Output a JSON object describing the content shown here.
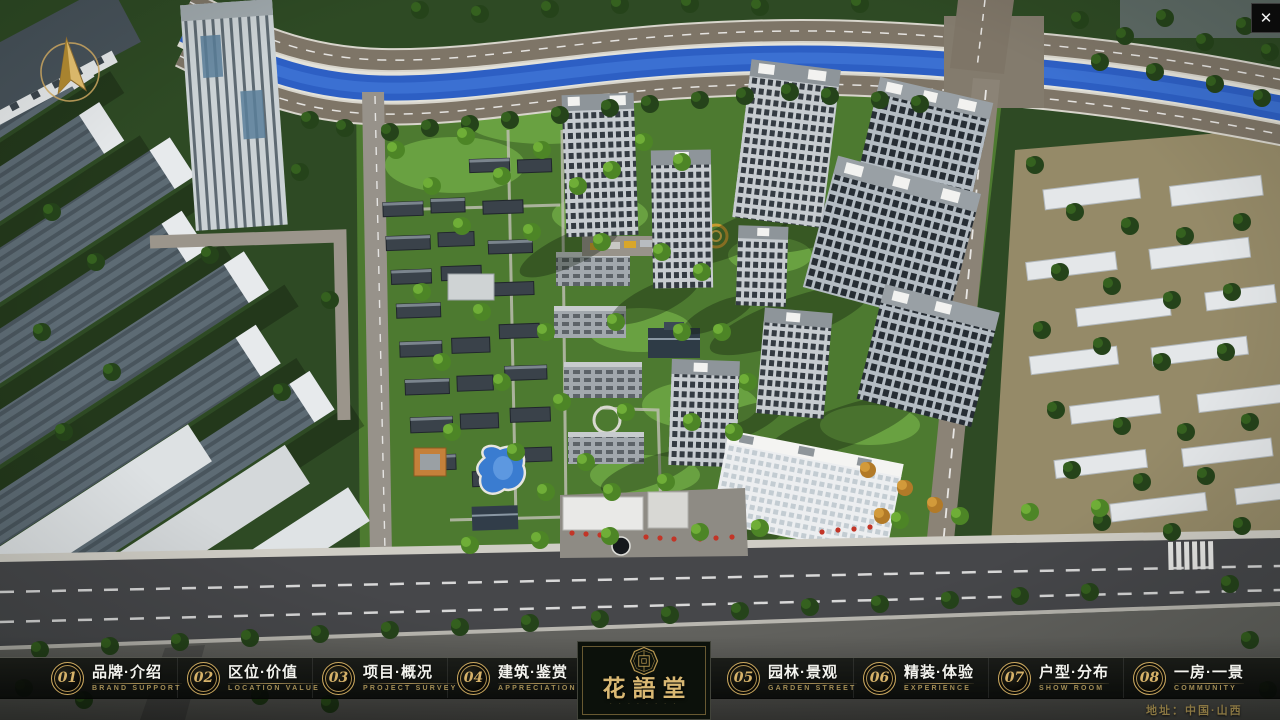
{
  "app": {
    "close_glyph": "✕"
  },
  "nav": {
    "items": [
      {
        "num": "01",
        "zh": "品牌·介绍",
        "en": "BRAND SUPPORT"
      },
      {
        "num": "02",
        "zh": "区位·价值",
        "en": "LOCATION VALUE"
      },
      {
        "num": "03",
        "zh": "项目·概况",
        "en": "PROJECT SURVEY"
      },
      {
        "num": "04",
        "zh": "建筑·鉴赏",
        "en": "APPRECIATION"
      },
      {
        "num": "05",
        "zh": "园林·景观",
        "en": "GARDEN STREET"
      },
      {
        "num": "06",
        "zh": "精装·体验",
        "en": "EXPERIENCE"
      },
      {
        "num": "07",
        "zh": "户型·分布",
        "en": "SHOW ROOM"
      },
      {
        "num": "08",
        "zh": "一房·一景",
        "en": "COMMUNITY"
      }
    ]
  },
  "logo": {
    "title": "花語堂",
    "tagline": "· · · · · · · ·"
  },
  "footer": {
    "address": "地址：中国·山西"
  },
  "colors": {
    "gold_accent": "#c9a55f",
    "river_blue": "#2f63c8",
    "flag_red": "#c23527",
    "bar_background": "rgba(10,12,9,0.85)"
  }
}
